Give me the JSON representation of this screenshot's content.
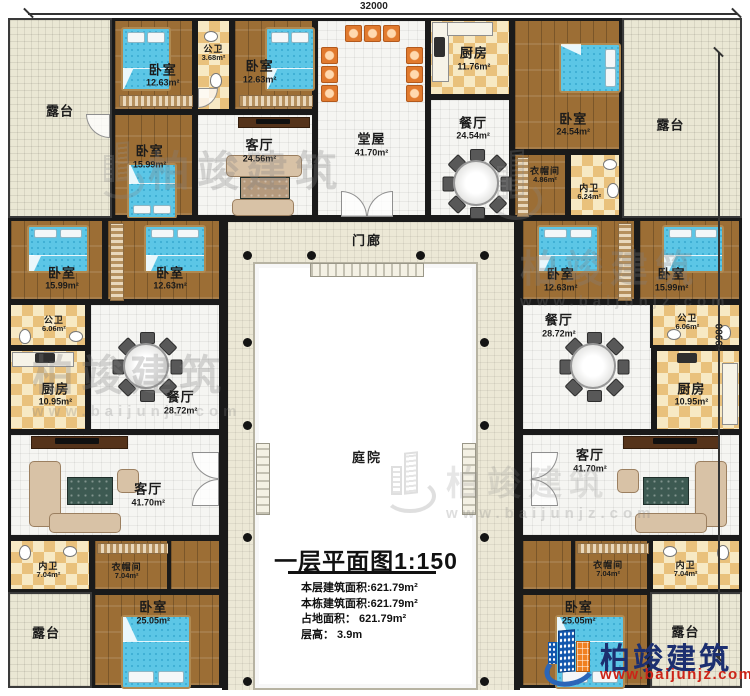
{
  "dimensions": {
    "width": "32000",
    "height": "29900"
  },
  "labels": {
    "porch": "门廊",
    "courtyard": "庭院"
  },
  "title_block": {
    "title": "一层平面图1:150",
    "lines": [
      "本层建筑面积:621.79m²",
      "本栋建筑面积:621.79m²",
      "占地面积： 621.79m²",
      "层高： 3.9m"
    ]
  },
  "watermark": {
    "brand": "柏竣建筑",
    "site": "www.baijunjz.com"
  },
  "logo": {
    "brand": "柏竣建筑",
    "site": "www.baijunjz.com"
  },
  "rooms": {
    "terrace_tl": {
      "name": "露台"
    },
    "bedroom_t1": {
      "name": "卧室",
      "area": "12.63m²"
    },
    "bath_t": {
      "name": "公卫",
      "area": "3.68m²"
    },
    "bedroom_t2": {
      "name": "卧室",
      "area": "12.63m²"
    },
    "bedroom_t3": {
      "name": "卧室",
      "area": "15.99m²"
    },
    "living_t": {
      "name": "客厅",
      "area": "24.56m²"
    },
    "hall": {
      "name": "堂屋",
      "area": "41.70m²"
    },
    "kitchen_t": {
      "name": "厨房",
      "area": "11.76m²"
    },
    "dining_t": {
      "name": "餐厅",
      "area": "24.54m²"
    },
    "bedroom_t4": {
      "name": "卧室",
      "area": "24.54m²"
    },
    "closet_tr": {
      "name": "衣帽间",
      "area": "4.86m²"
    },
    "bath_tr": {
      "name": "内卫",
      "area": "6.24m²"
    },
    "terrace_tr": {
      "name": "露台"
    },
    "bedroom_ml1": {
      "name": "卧室",
      "area": "15.99m²"
    },
    "bedroom_ml2": {
      "name": "卧室",
      "area": "12.63m²"
    },
    "bath_ml": {
      "name": "公卫",
      "area": "6.06m²"
    },
    "kitchen_ml": {
      "name": "厨房",
      "area": "10.95m²"
    },
    "dining_ml": {
      "name": "餐厅",
      "area": "28.72m²"
    },
    "living_bl": {
      "name": "客厅",
      "area": "41.70m²"
    },
    "bath_bl": {
      "name": "内卫",
      "area": "7.04m²"
    },
    "closet_bl": {
      "name": "衣帽间",
      "area": "7.04m²"
    },
    "bedroom_bl": {
      "name": "卧室",
      "area": "25.05m²"
    },
    "terrace_bl": {
      "name": "露台"
    },
    "bedroom_mr1": {
      "name": "卧室",
      "area": "12.63m²"
    },
    "bedroom_mr2": {
      "name": "卧室",
      "area": "15.99m²"
    },
    "bath_mr": {
      "name": "公卫",
      "area": "6.06m²"
    },
    "kitchen_mr": {
      "name": "厨房",
      "area": "10.95m²"
    },
    "dining_mr": {
      "name": "餐厅",
      "area": "28.72m²"
    },
    "living_br": {
      "name": "客厅",
      "area": "41.70m²"
    },
    "closet_br": {
      "name": "衣帽间",
      "area": "7.04m²"
    },
    "bath_br": {
      "name": "内卫",
      "area": "7.04m²"
    },
    "bedroom_br": {
      "name": "卧室",
      "area": "25.05m²"
    },
    "terrace_br": {
      "name": "露台"
    }
  }
}
